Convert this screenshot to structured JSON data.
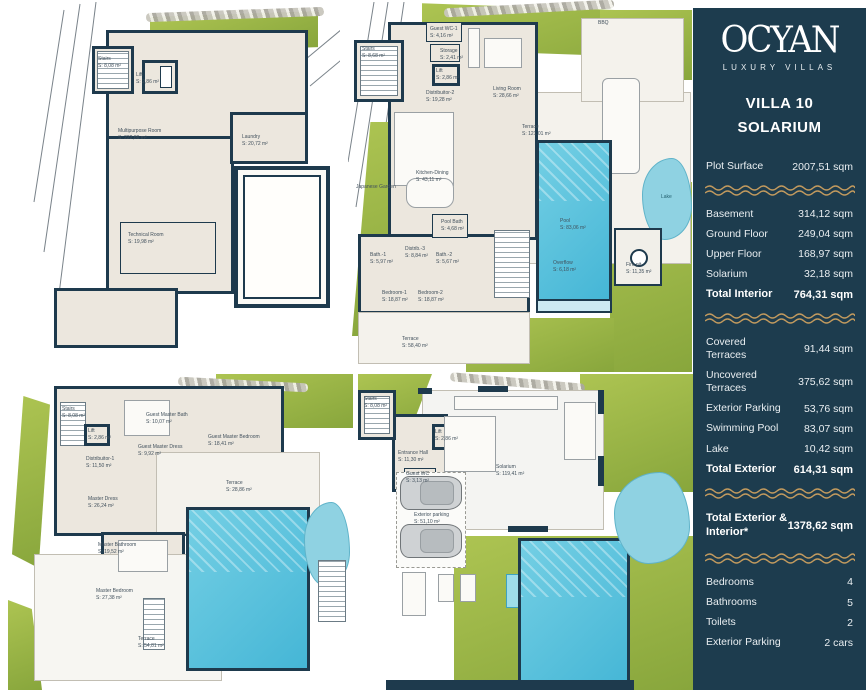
{
  "sidebar": {
    "brand": {
      "name": "OCYAN",
      "tagline": "LUXURY VILLAS"
    },
    "villa_title": {
      "line1": "VILLA 10",
      "line2": "SOLARIUM"
    },
    "plot_row": {
      "label": "Plot Surface",
      "value": "2007,51 sqm"
    },
    "interior_rows": [
      {
        "label": "Basement",
        "value": "314,12 sqm"
      },
      {
        "label": "Ground Floor",
        "value": "249,04 sqm"
      },
      {
        "label": "Upper Floor",
        "value": "168,97 sqm"
      },
      {
        "label": "Solarium",
        "value": "32,18 sqm"
      },
      {
        "label": "Total Interior",
        "value": "764,31 sqm"
      }
    ],
    "exterior_rows": [
      {
        "label": "Covered Terraces",
        "value": "91,44 sqm"
      },
      {
        "label": "Uncovered Terraces",
        "value": "375,62 sqm"
      },
      {
        "label": "Exterior Parking",
        "value": "53,76 sqm"
      },
      {
        "label": "Swimming Pool",
        "value": "83,07 sqm"
      },
      {
        "label": "Lake",
        "value": "10,42 sqm"
      },
      {
        "label": "Total Exterior",
        "value": "614,31 sqm"
      }
    ],
    "grand_total_row": {
      "label": "Total Exterior & Interior*",
      "value": "1378,62 sqm"
    },
    "feature_rows": [
      {
        "label": "Bedrooms",
        "value": "4"
      },
      {
        "label": "Bathrooms",
        "value": "5"
      },
      {
        "label": "Toilets",
        "value": "2"
      },
      {
        "label": "Exterior Parking",
        "value": "2 cars"
      }
    ],
    "colors": {
      "background": "#1d3c4e",
      "wave_accent": "#c29a5e",
      "text": "#ffffff"
    }
  },
  "plans": {
    "basement": {
      "rooms": [
        {
          "name": "Stairs",
          "area": "S: 8,08 m²"
        },
        {
          "name": "Lift",
          "area": "S: 2,86 m²"
        },
        {
          "name": "Multipurpose Room",
          "area": "S: 222,86 m²"
        },
        {
          "name": "Laundry",
          "area": "S: 20,72 m²"
        },
        {
          "name": "Technical Room",
          "area": "S: 19,98 m²"
        }
      ]
    },
    "ground": {
      "rooms": [
        {
          "name": "Stairs",
          "area": "S: 8,68 m²"
        },
        {
          "name": "Guest WC-1",
          "area": "S: 4,16 m²"
        },
        {
          "name": "Storage",
          "area": "S: 2,41 m²"
        },
        {
          "name": "Lift",
          "area": "S: 2,86 m²"
        },
        {
          "name": "Distribuitor-2",
          "area": "S: 19,28 m²"
        },
        {
          "name": "Living Room",
          "area": "S: 28,66 m²"
        },
        {
          "name": "Terrace",
          "area": "S: 121,01 m²"
        },
        {
          "name": "Japanese Garden",
          "area": ""
        },
        {
          "name": "Kitchen-Dining",
          "area": "S: 43,11 m²"
        },
        {
          "name": "Pool Bath",
          "area": "S: 4,68 m²"
        },
        {
          "name": "Bath.-1",
          "area": "S: 5,97 m²"
        },
        {
          "name": "Distrib.-3",
          "area": "S: 8,84 m²"
        },
        {
          "name": "Bath.-2",
          "area": "S: 5,67 m²"
        },
        {
          "name": "Bedroom-1",
          "area": "S: 18,87 m²"
        },
        {
          "name": "Bedroom-2",
          "area": "S: 18,87 m²"
        },
        {
          "name": "Terrace",
          "area": "S: 58,40 m²"
        },
        {
          "name": "Pool",
          "area": "S: 83,06 m²"
        },
        {
          "name": "Overflow",
          "area": "S: 6,18 m²"
        },
        {
          "name": "BBQ",
          "area": ""
        },
        {
          "name": "Lake",
          "area": ""
        },
        {
          "name": "Fire pit",
          "area": "S: 11,35 m²"
        }
      ]
    },
    "upper": {
      "rooms": [
        {
          "name": "Stairs",
          "area": "S: 8,08 m²"
        },
        {
          "name": "Lift",
          "area": "S: 2,86 m²"
        },
        {
          "name": "Guest Master Bath",
          "area": "S: 10,07 m²"
        },
        {
          "name": "Guest Master Dress",
          "area": "S: 9,92 m²"
        },
        {
          "name": "Guest Master Bedroom",
          "area": "S: 18,41 m²"
        },
        {
          "name": "Distribuitor-1",
          "area": "S: 11,50 m²"
        },
        {
          "name": "Master Dress",
          "area": "S: 26,24 m²"
        },
        {
          "name": "Master Bathroom",
          "area": "S: 19,52 m²"
        },
        {
          "name": "Master Bedroom",
          "area": "S: 27,38 m²"
        },
        {
          "name": "Terrace",
          "area": "S: 28,86 m²"
        },
        {
          "name": "Terrace",
          "area": "S: 54,81 m²"
        }
      ]
    },
    "solarium": {
      "rooms": [
        {
          "name": "Stairs",
          "area": "S: 8,08 m²"
        },
        {
          "name": "Lift",
          "area": "S: 2,86 m²"
        },
        {
          "name": "Entrance Hall",
          "area": "S: 11,30 m²"
        },
        {
          "name": "Guest WC",
          "area": "S: 3,13 m²"
        },
        {
          "name": "Solarium",
          "area": "S: 119,41 m²"
        },
        {
          "name": "Exterior parking",
          "area": "S: 51,10 m²"
        }
      ]
    }
  }
}
